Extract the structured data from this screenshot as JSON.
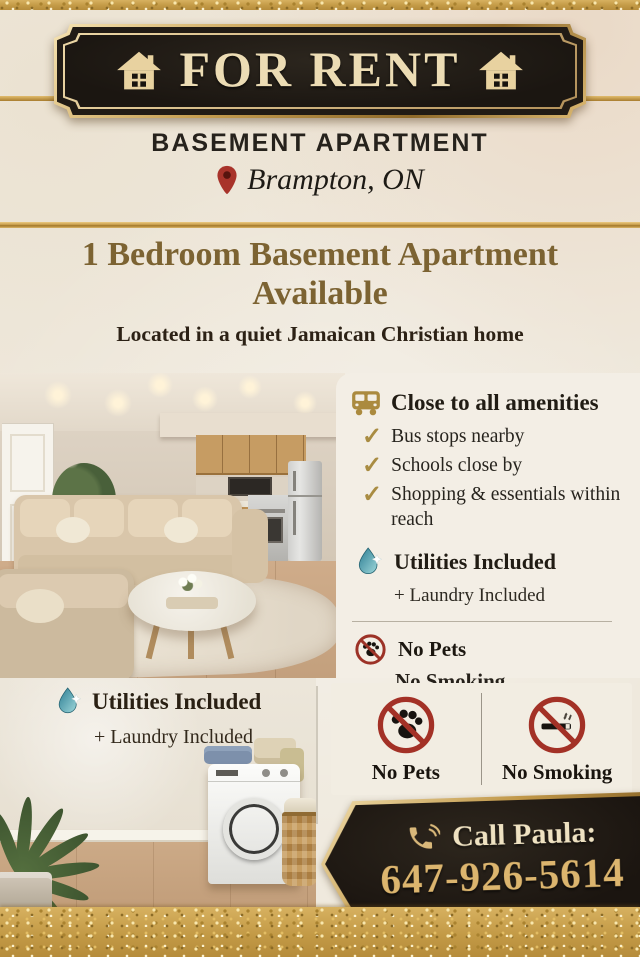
{
  "poster": {
    "colors": {
      "gold_accent": "#c39a46",
      "plaque_black": "#1f1a14",
      "headline_gold": "#7c6332",
      "prohibition_red": "#9c3227",
      "water_drop_blue": "#3a8ca0",
      "cream_text": "#ecdcb4",
      "background_cream": "#efe9dd"
    },
    "sign": {
      "title": "FOR RENT",
      "left_icon": "house-icon",
      "right_icon": "house-icon"
    },
    "header": {
      "subtitle": "BASEMENT APARTMENT",
      "pin_icon": "location-pin-icon",
      "location": "Brampton, ON"
    },
    "headline": {
      "line1": "1 Bedroom Basement Apartment",
      "line2": "Available",
      "tagline": "Located in a quiet Jamaican Christian home"
    },
    "amenities": {
      "icon": "bus-icon",
      "title": "Close to all amenities",
      "check_glyph": "✓",
      "items": [
        "Bus stops nearby",
        "Schools close by",
        "Shopping & essentials within reach"
      ]
    },
    "utilities": {
      "icon": "water-drop-icon",
      "title": "Utilities Included",
      "subtitle": "+ Laundry Included"
    },
    "rules": {
      "icon": "no-pets-icon",
      "line1": "No Pets",
      "line2": "No Smoking"
    },
    "laundry": {
      "icon": "water-drop-icon",
      "title": "Utilities Included",
      "subtitle": "+ Laundry Included"
    },
    "badges": [
      {
        "icon": "no-pets-icon",
        "label": "No Pets"
      },
      {
        "icon": "no-smoking-icon",
        "label": "No Smoking"
      }
    ],
    "contact": {
      "icon": "phone-icon",
      "label": "Call Paula:",
      "phone": "647-926-5614"
    }
  }
}
